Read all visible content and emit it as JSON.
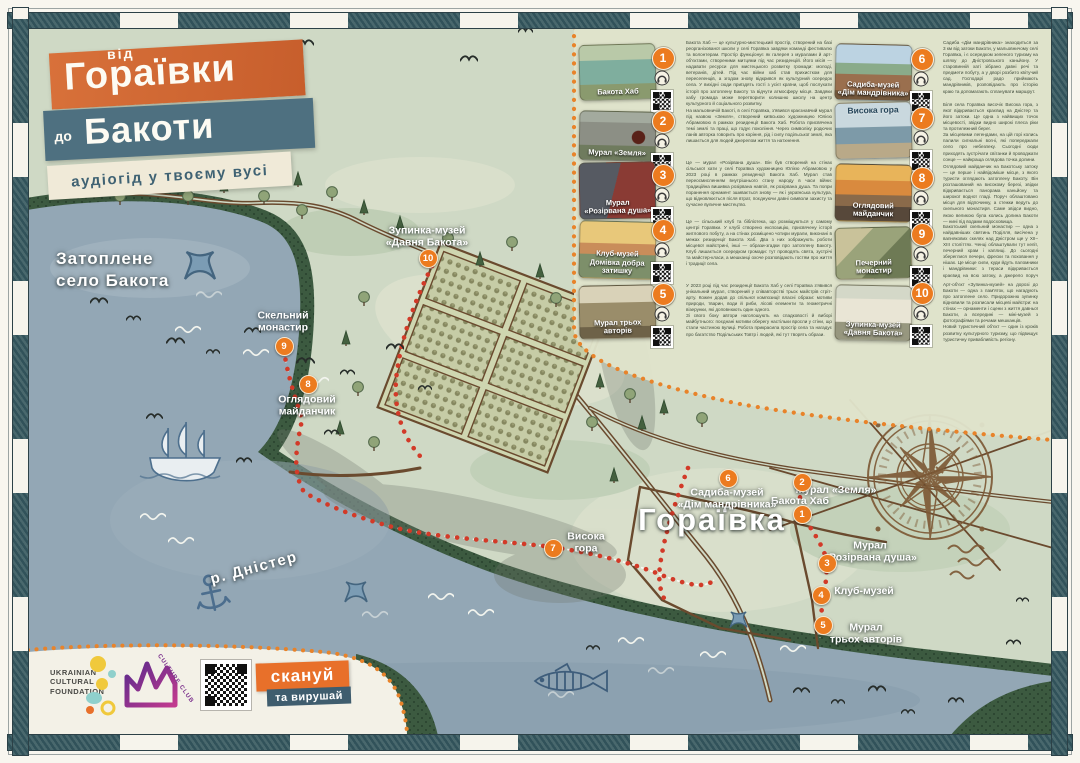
{
  "title": {
    "small1": "від",
    "big1": "Гораївки",
    "small2": "до",
    "big2": "Бакоти",
    "subtitle": "аудіогід у твоєму вусі"
  },
  "map": {
    "water_label": "Затоплене\nсело Бакота",
    "river_label": "р. Дністер",
    "village_label": "Гораївка",
    "markers": [
      {
        "num": "1",
        "label": "Бакота Хаб"
      },
      {
        "num": "2",
        "label": "Мурал «Земля»"
      },
      {
        "num": "3",
        "label": "Мурал\n«Розірвана душа»"
      },
      {
        "num": "4",
        "label": "Клуб-музей"
      },
      {
        "num": "5",
        "label": "Мурал\nтрьох авторів"
      },
      {
        "num": "6",
        "label": "Садиба-музей\n«Дім мандрівника»"
      },
      {
        "num": "7",
        "label": "Висока\nгора"
      },
      {
        "num": "8",
        "label": "Оглядовий\nмайданчик"
      },
      {
        "num": "9",
        "label": "Скельний\nмонастир"
      },
      {
        "num": "10",
        "label": "Зупинка-музей\n«Давня Бакота»"
      }
    ]
  },
  "legend": {
    "items": [
      {
        "num": "1",
        "caption": "Бакота Хаб",
        "body": "Бакота Хаб — це культурно-мистецький простір, створений на базі реорганізованої школи у селі Гораївка завдяки команді фестивалю та волонтерам. Простір функціонує як галерея з муралами й арт-об'єктами, створеними митцями під час резиденцій. Його місія — надавати ресурси для мистецького розвитку громади: молоді, ветеранів, дітей. Під час війни хаб став прихистком для переселенців, а згодом знову відкрився як культурний осередок села. У вихідні сюди приїздять гості з усієї країни, щоб послухати історії про затоплену Бакоту та відчути атмосферу місця. Завдяки хабу громада може перетворити колишню школу на центр культурного й соціального розвитку."
      },
      {
        "num": "2",
        "caption": "Мурал «Земля»",
        "body": "На мальовничій Бакоті, в селі Гораївка, з'явився краєзнавчий мурал під назвою «Земля», створений київською художницею Юлією Абрамовою в рамках резиденції Бакота Хаб. Робота присвячена темі землі та праці, що годує покоління. Через символіку родючих ланів авторка говорить про коріння, рід і силу подільської землі, яка лишається для людей джерелом життя та натхнення."
      },
      {
        "num": "3",
        "caption": "Мурал\n«Розірвана душа»",
        "body": "Це — мурал «Розірвана душа». Він був створений на стінах сільської хати у селі Гораївка художницею Юлією Абрамовою у 2023 році в рамках резиденції Бакота Хаб. Мурал став переосмисленням внутрішнього стану народу в часи війни: традиційна вишивка розірвана навпіл, як розірвана душа. Та попри поранення орнамент зшивається знову — як і українська культура, що відновлюється після втрат, поєднуючи давні символи захисту та сучасне вуличне мистецтво."
      },
      {
        "num": "4",
        "caption": "Клуб-музей\nДомівка добра затишку",
        "body": "Це — сільський клуб та бібліотека, що розміщуються у самому центрі Гораївки. У клубі створено експозицію, присвячену історії житлового побуту, а на стінах розміщено чотири мурали, виконані в межах резиденції Бакота Хаб. Два з них зображують роботи місцевої майстрині, інші — образи-згадки про затоплену Бакоту. Клуб лишається осередком громади: тут проводять свята, зустрічі та майстер-класи, а мешканці охоче розповідають гостям про життя і традиції села."
      },
      {
        "num": "5",
        "caption": "Мурал трьох авторів",
        "body": "У 2023 році під час резиденції Бакота Хаб у селі Гораївка з'явився унікальний мурал, створений у співавторстві трьох майстрів стріт-арту. Кожен додав до спільної композиції власні образи: мотиви природи, тварин, води й риби, лісові елементи та геометричні візерунки, які доповнюють один одного.\nЗі свого боку автори наголошують на спадковості й виборі майбутнього: поєднані мотиви оберегу настільки вросли у стіни, що стали частиною вулиці. Робота прикрасила простір села та нагадує про багатство Подільських Товтр і людей, які тут творять образи."
      },
      {
        "num": "6",
        "caption": "Садиба-музей\n«Дім мандрівника»",
        "body": "Садиба «Дім мандрівника» знаходиться за 3 км від затоки Бакоти, у мальовничому селі Гораївка, і є осередком зеленого туризму на шляху до Дністровського каньйону. У старовинній хаті зібрано давні речі та предмети побуту, а у дворі розбито квітучий сад. Господарі радо приймають мандрівників, розповідають про історію краю та допомагають спланувати маршрут."
      },
      {
        "num": "7",
        "caption": "Висока гора",
        "body": "Біля села Гораївка височіє Висока гора, з якої відкривається краєвид на Дністер та його затоки. Це одна з найвищих точок місцевості, звідки видно широкі плеса ріки та протилежний берег.\nЗа місцевими легендами, на цій горі колись палили сигнальні вогні, які попереджали село про небезпеку. Сьогодні сюди приходять зустрічати світанки й проводжати сонце — найкраща оглядова точка долини."
      },
      {
        "num": "8",
        "caption": "Оглядовий\nмайданчик",
        "body": "Оглядовий майданчик на Бакотську затоку — це перше і найвідоміше місце, з якого туристи оглядають затоплену Бакоту. Він розташований на високому березі, звідки відкривається панорама каньйону та широкої водної гладі. Поруч облаштовано місця для відпочинку, а стежки ведуть до скельного монастиря. Саме звідси видно, якою великою була колись долина Бакоти — нині під водами водосховища."
      },
      {
        "num": "9",
        "caption": "Печерний монастир",
        "body": "Бакотський скельний монастир — одна з найдавніших святинь Поділля, висічена у вапнякових скелях над Дністром ще у XII–XIII століттях. Ченці облаштували тут келії, печерний храм і каплиці. До сьогодні збереглися печери, фрески та поховання у нішах. Це місце сили, куди йдуть паломники і мандрівники: з тераси відкривається краєвид на всю затоку, а джерело поруч вважають цілющим."
      },
      {
        "num": "10",
        "caption": "Зупинка-музей\n«Давня Бакота»",
        "body": "Арт-об'єкт «Зупинка-музей» на дорозі до Бакоти — одна з пам'яток, що нагадують про затоплене село. Придорожню зупинку відновили та розписали місцеві майстри: на стінах — орнаменти і сцени з життя давньої Бакоти, а всередині — міні-музей з фотографіями та речами мешканців.\nНовий туристичний об'єкт — один із кроків розвитку культурного туризму, що підвищує туристичну привабливість регіону."
      }
    ]
  },
  "footer": {
    "ucf": [
      "UKRAINIAN",
      "CULTURAL",
      "FOUNDATION"
    ],
    "club": "CULTURE CLUB",
    "scan1": "скануй",
    "scan2": "та вирушай"
  },
  "colors": {
    "accent_orange": "#e8702a",
    "accent_teal": "#4e7080",
    "trail_red": "#d23a28",
    "marker_orange": "#ec7b1f",
    "road_brown": "#6a4a2e"
  }
}
